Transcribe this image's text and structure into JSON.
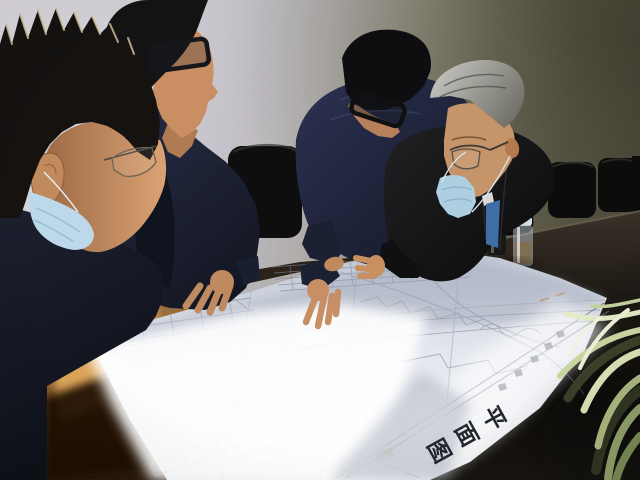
{
  "scene": {
    "description": "Indoor meeting-room photograph: four men in dark jackets lean over a conference table studying a large unfolded engineering site-plan drawing; bright sunlight falls diagonally across the paper and a wooden desk; black office chairs and an olive wall in the background; spider-plant leaves enter at bottom right.",
    "room": "meeting room with light wall on the left fading to dark olive wall on the right"
  },
  "people": [
    {
      "id": "man-1",
      "position": "extreme foreground left",
      "features": "short spiky black hair with backlit tips, wire-rim glasses, light blue surgical mask pulled below chin, dark navy jacket"
    },
    {
      "id": "man-2",
      "position": "left, bending over the table",
      "features": "black hair, dark rectangular glasses, navy jacket over dark shirt, right hand resting on the drawing"
    },
    {
      "id": "man-3",
      "position": "center, head bowed",
      "features": "black hair, black thick-rimmed glasses, navy hooded jacket, right hand touching the drawing"
    },
    {
      "id": "man-4",
      "position": "right",
      "features": "gray combed hair, thin metal glasses, light blue surgical mask at chin, black coat, white shirt with blue tie"
    }
  ],
  "blueprint": {
    "type": "large folded site plan / floor plan with fine gray line work, schedule tables, parcel outlines and a title strip",
    "title": "平面图",
    "title_chars": [
      "图",
      "面",
      "平"
    ]
  },
  "objects": {
    "thermos": "stainless vacuum flask on conference table",
    "tea_bottle": "glass tea bottle with pale blue lid",
    "chairs": "black leather office chair backs along the wall",
    "plant": "variegated spider-plant leaves, sunlit, bottom right",
    "wood_table": "warm brown wooden desk, bottom left, with sun patch and shadow",
    "conference_table": "dark brown-black conference table on the right"
  },
  "palette": {
    "wall_left": "#d4d1d8",
    "wall_right": "#4c4a3a",
    "paper": "#eef0f4",
    "paper_shadow": "#a9b1c2",
    "wood": "#a06a33",
    "dark_table": "#17130e",
    "mask_blue": "#b5d2e2",
    "skin": "#c9946b",
    "navy_clothing": "#1b2030",
    "plant_leaf": "#cdd8a8",
    "tie_blue": "#3f6da6"
  }
}
